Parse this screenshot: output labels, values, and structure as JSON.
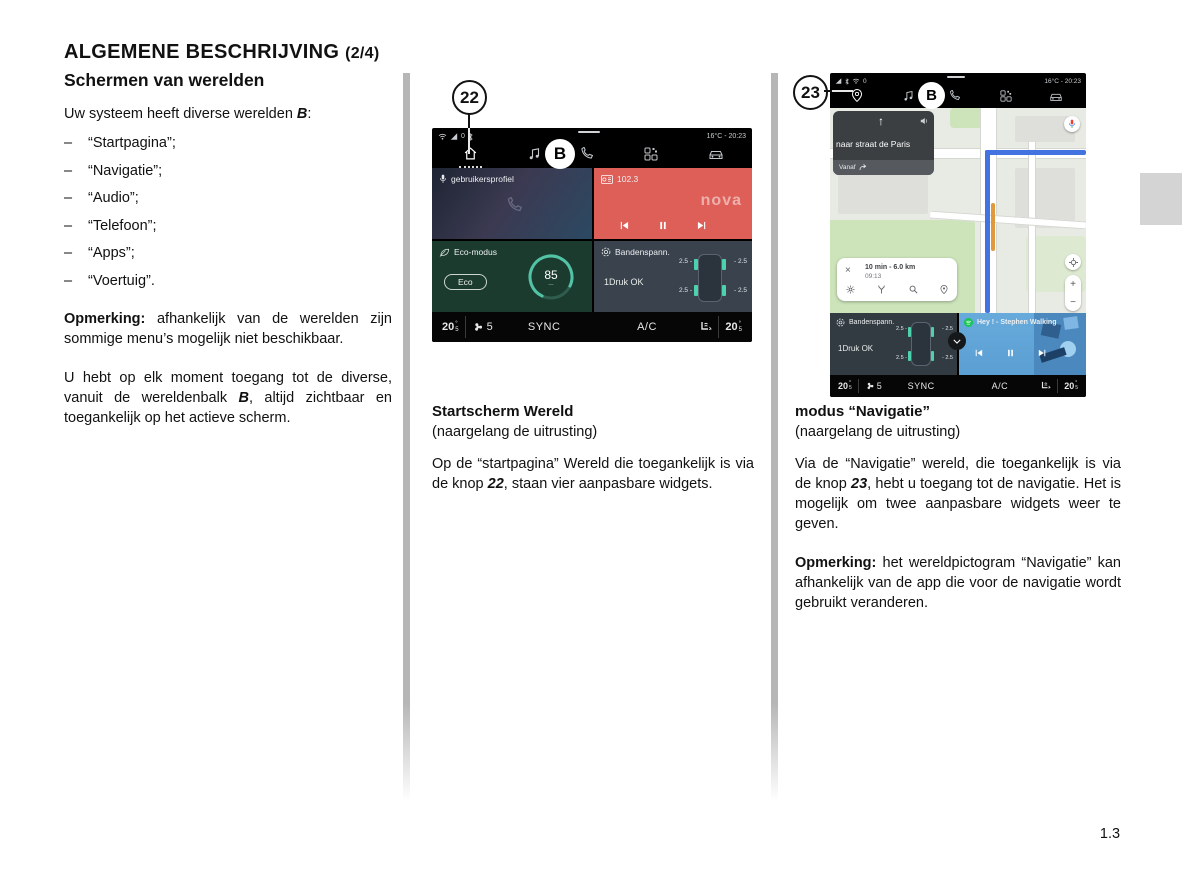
{
  "page": {
    "title": "ALGEMENE BESCHRIJVING",
    "title_suffix": "(2/4)",
    "page_number": "1.3"
  },
  "left_column": {
    "heading": "Schermen van werelden",
    "intro_pre": "Uw systeem heeft diverse werelden ",
    "intro_b": "B",
    "intro_post": ":",
    "bullet_dash": "–",
    "bullets": [
      "“Startpagina”;",
      "“Navigatie”;",
      "“Audio”;",
      "“Telefoon”;",
      "“Apps”;",
      "“Voertuig”."
    ],
    "note_label": "Opmerking:",
    "note_text": " afhankelijk van de werelden zijn sommige menu’s mogelijk niet beschik­baar.",
    "para2_pre": "U hebt op elk moment toegang tot de di­verse, vanuit de wereldenbalk ",
    "para2_b": "B",
    "para2_post": ", altijd zicht­baar en toegankelijk op het actieve scherm."
  },
  "screen_home": {
    "callout": "22",
    "status_zero": "0",
    "temp_time": "16°C - 20:23",
    "world_label": "B",
    "profile_label": "gebruikersprofiel",
    "radio_station": "102.3",
    "radio_brand": "nova",
    "eco_title": "Eco-modus",
    "eco_button": "Eco",
    "eco_score": "85",
    "tyre_title": "Bandenspann.",
    "tyre_status": "1Druk OK",
    "tyre_fl": "2.5 -",
    "tyre_fr": "- 2.5",
    "tyre_rl": "2.5 -",
    "tyre_rr": "- 2.5",
    "climate": {
      "deg": "°",
      "temp_left": "20",
      "temp_left_frac": "5",
      "fan_level": "5",
      "sync": "SYNC",
      "ac": "A/C",
      "temp_right": "20",
      "temp_right_frac": "5"
    }
  },
  "screen_nav": {
    "callout": "23",
    "status_zero": "0",
    "temp_time": "16°C - 20:23",
    "world_label": "B",
    "nav_destination": "naar straat de Paris",
    "nav_from": "Vanaf",
    "route_summary": "10 min - 6.0 km",
    "route_eta": "09:13",
    "close": "×",
    "zoom_in": "+",
    "zoom_out": "−",
    "tyre_title": "Bandenspann.",
    "tyre_status": "1Druk OK",
    "tyre_fl": "2.5 -",
    "tyre_fr": "- 2.5",
    "tyre_rl": "2.5 -",
    "tyre_rr": "- 2.5",
    "media_track": "Hey ! - Stephen Walking",
    "climate": {
      "deg": "°",
      "temp_left": "20",
      "temp_left_frac": "5",
      "fan_level": "5",
      "sync": "SYNC",
      "ac": "A/C",
      "temp_right": "20",
      "temp_right_frac": "5"
    }
  },
  "caption_home": {
    "title": "Startscherm Wereld",
    "subtitle": "(naargelang de uitrusting)",
    "body_pre": "Op de “startpagina” Wereld die toeganke­lijk is via de knop ",
    "body_b": "22",
    "body_post": ", staan vier aanpasbare widgets."
  },
  "caption_nav": {
    "title": "modus “Navigatie”",
    "subtitle": "(naargelang de uitrusting)",
    "body_pre": "Via de “Navigatie” wereld, die toegankelijk is via de knop ",
    "body_b": "23",
    "body_post": ", hebt u toegang tot de navi­gatie. Het is mogelijk om twee aanpasbare widgets weer te geven.",
    "note_label": "Opmerking:",
    "note_text": " het wereldpictogram “Navigatie” kan afhankelijk van de app die voor de navigatie wordt gebruikt verande­ren."
  }
}
